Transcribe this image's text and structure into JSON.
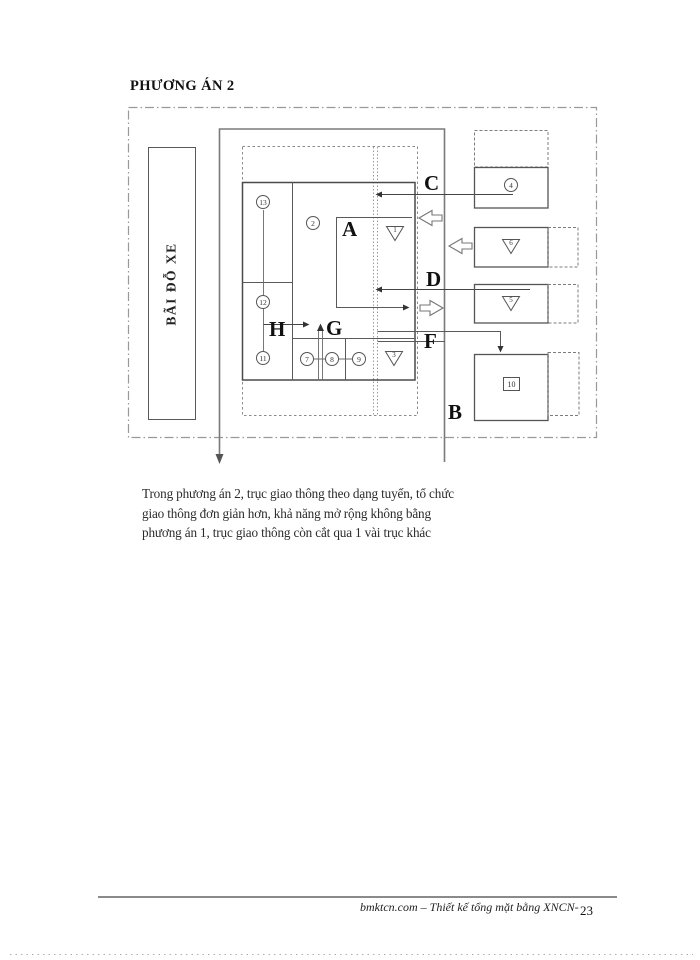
{
  "page": {
    "title": "PHƯƠNG ÁN 2",
    "paragraph": {
      "lines": [
        "Trong phương án 2, trục giao thông theo dạng tuyến, tổ chức",
        "giao thông đơn giản hơn, khả năng mở rộng không bằng",
        "phương án 1, trục giao thông còn cắt qua 1 vài trục khác"
      ]
    },
    "footer": {
      "source": "bmktcn.com – Thiết kế tổng mặt bằng XNCN-",
      "page_number": "23"
    }
  },
  "diagram": {
    "parking_label": "BÃI ĐỖ XE",
    "letters": {
      "a": "A",
      "b": "B",
      "c": "C",
      "d": "D",
      "f": "F",
      "g": "G",
      "h": "H"
    },
    "units": {
      "circle_2": "2",
      "circle_4": "4",
      "circle_7": "7",
      "circle_8": "8",
      "circle_9": "9",
      "circle_11": "11",
      "circle_12": "12",
      "circle_13": "13",
      "triangle_1": "1",
      "triangle_3": "3",
      "triangle_5": "5",
      "triangle_6": "6",
      "square_10": "10"
    },
    "colors": {
      "line": "#555555",
      "road": "#7a7a7a",
      "border": "#999999",
      "text": "#1a1a1a"
    }
  }
}
